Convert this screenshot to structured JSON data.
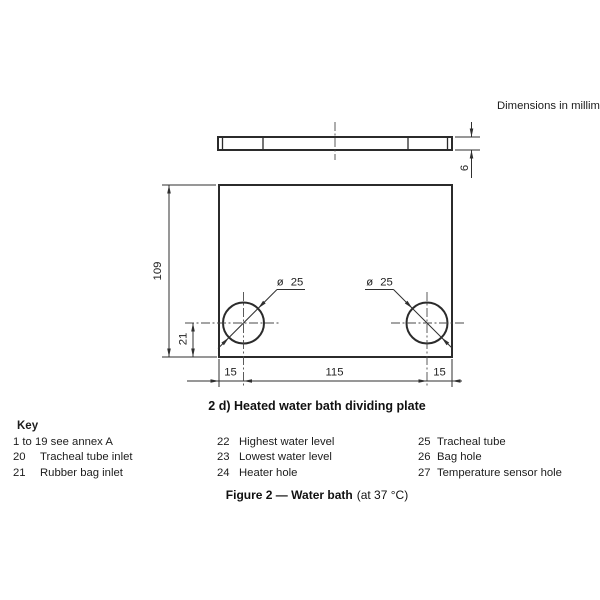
{
  "page": {
    "units_note": "Dimensions in millimet",
    "drawing_caption": "2 d) Heated water bath dividing plate",
    "figure_caption_bold": "Figure 2 — Water bath",
    "figure_caption_regular": "(at 37 °C)"
  },
  "dimensions": {
    "plate_thickness": "6",
    "plate_height": "109",
    "hole_center_from_bottom": "21",
    "left_edge_to_hole": "15",
    "hole_spacing": "115",
    "hole_to_right_edge": "15",
    "left_hole_diameter": "ø 25",
    "right_hole_diameter": "ø 25"
  },
  "key": {
    "title": "Key",
    "columns": [
      {
        "items": [
          {
            "num": "",
            "label": "1 to 19 see annex A"
          },
          {
            "num": "20",
            "label": "Tracheal tube inlet"
          },
          {
            "num": "21",
            "label": "Rubber bag inlet"
          }
        ]
      },
      {
        "items": [
          {
            "num": "22",
            "label": "Highest water level"
          },
          {
            "num": "23",
            "label": "Lowest water level"
          },
          {
            "num": "24",
            "label": "Heater hole"
          }
        ]
      },
      {
        "items": [
          {
            "num": "25",
            "label": "Tracheal tube"
          },
          {
            "num": "26",
            "label": "Bag hole"
          },
          {
            "num": "27",
            "label": "Temperature sensor hole"
          }
        ]
      }
    ]
  }
}
